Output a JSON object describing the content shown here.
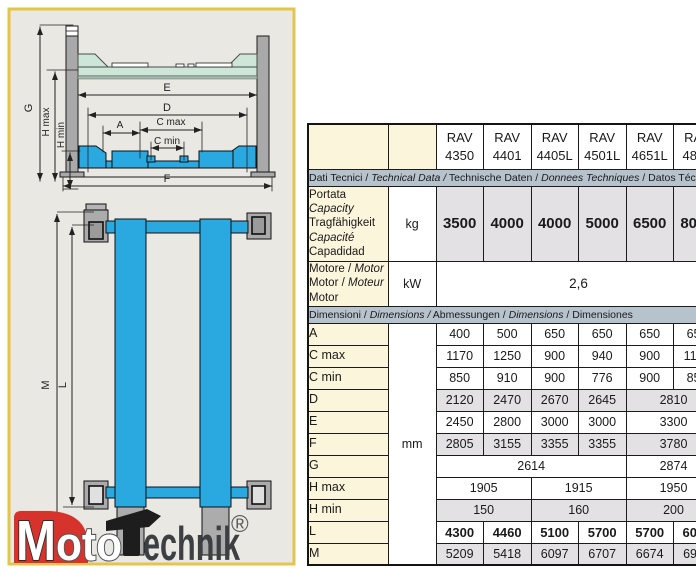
{
  "diagram": {
    "front_labels": {
      "G": "G",
      "h_max": "H max",
      "h_min": "H min",
      "E": "E",
      "D": "D",
      "A": "A",
      "c_max": "C max",
      "c_min": "C min",
      "F": "F"
    },
    "plan_labels": {
      "M": "M",
      "L": "L"
    },
    "colors": {
      "panel_bg": "#EAE8E3",
      "panel_border": "#E4C44C",
      "post_gray": "#A9A9A9",
      "platform_mint": "#CDE6D8",
      "platform_blue": "#2AA9E0"
    }
  },
  "logo": {
    "m": "M",
    "oto": "oto",
    "technik": "echnik",
    "reg": "®",
    "brand_red": "#D6332C"
  },
  "table": {
    "models": [
      {
        "l1": "RAV",
        "l2": "4350"
      },
      {
        "l1": "RAV",
        "l2": "4401"
      },
      {
        "l1": "RAV",
        "l2": "4405L"
      },
      {
        "l1": "RAV",
        "l2": "4501L"
      },
      {
        "l1": "RAV",
        "l2": "4651L"
      },
      {
        "l1": "RAV",
        "l2": "4800"
      }
    ],
    "sections": {
      "tech": [
        {
          "t": "Dati Tecnici / "
        },
        {
          "t": "Technical Data /",
          "i": true
        },
        {
          "t": " Technische Daten / "
        },
        {
          "t": "Donnees Techniques",
          "i": true
        },
        {
          "t": " / Datos Técnicos"
        }
      ],
      "dim": [
        {
          "t": "Dimensioni / "
        },
        {
          "t": "Dimensions /",
          "i": true
        },
        {
          "t": " Abmessungen / "
        },
        {
          "t": "Dimensions",
          "i": true
        },
        {
          "t": " / Dimensiones"
        }
      ]
    },
    "capacity": {
      "label": [
        {
          "t": "Portata"
        },
        {
          "t": "Capacity",
          "i": true
        },
        {
          "t": "Tragfähigkeit"
        },
        {
          "t": "Capacité",
          "i": true
        },
        {
          "t": "Capadidad"
        }
      ],
      "unit": "kg",
      "values": [
        "3500",
        "4000",
        "4000",
        "5000",
        "6500",
        "8000"
      ]
    },
    "motor": {
      "label": [
        [
          {
            "t": "Motore / "
          },
          {
            "t": "Motor",
            "i": true
          }
        ],
        [
          {
            "t": "Motor / "
          },
          {
            "t": "Moteur",
            "i": true
          }
        ],
        [
          {
            "t": "Motor"
          }
        ]
      ],
      "unit": "kW",
      "value": "2,6"
    },
    "dim_unit": "mm",
    "rows": [
      {
        "label": "A",
        "shaded": false,
        "bold": false,
        "cells": [
          {
            "v": "400"
          },
          {
            "v": "500"
          },
          {
            "v": "650"
          },
          {
            "v": "650"
          },
          {
            "v": "650"
          },
          {
            "v": "650"
          }
        ]
      },
      {
        "label": "C max",
        "shaded": false,
        "bold": false,
        "cells": [
          {
            "v": "1170"
          },
          {
            "v": "1250"
          },
          {
            "v": "900"
          },
          {
            "v": "940"
          },
          {
            "v": "900"
          },
          {
            "v": "1150"
          }
        ]
      },
      {
        "label": "C min",
        "shaded": false,
        "bold": false,
        "cells": [
          {
            "v": "850"
          },
          {
            "v": "910"
          },
          {
            "v": "900"
          },
          {
            "v": "776"
          },
          {
            "v": "900"
          },
          {
            "v": "850"
          }
        ]
      },
      {
        "label": "D",
        "shaded": true,
        "bold": false,
        "cells": [
          {
            "v": "2120"
          },
          {
            "v": "2470"
          },
          {
            "v": "2670"
          },
          {
            "v": "2645"
          },
          {
            "v": "2810",
            "span": 2
          }
        ]
      },
      {
        "label": "E",
        "shaded": false,
        "bold": false,
        "cells": [
          {
            "v": "2450"
          },
          {
            "v": "2800"
          },
          {
            "v": "3000"
          },
          {
            "v": "3000"
          },
          {
            "v": "3300",
            "span": 2
          }
        ]
      },
      {
        "label": "F",
        "shaded": true,
        "bold": false,
        "cells": [
          {
            "v": "2805"
          },
          {
            "v": "3155"
          },
          {
            "v": "3355"
          },
          {
            "v": "3355"
          },
          {
            "v": "3780",
            "span": 2
          }
        ]
      },
      {
        "label": "G",
        "shaded": false,
        "bold": false,
        "cells": [
          {
            "v": "2614",
            "span": 4
          },
          {
            "v": "2874",
            "span": 2
          }
        ]
      },
      {
        "label": "H max",
        "shaded": false,
        "bold": false,
        "cells": [
          {
            "v": "1905",
            "span": 2
          },
          {
            "v": "1915",
            "span": 2
          },
          {
            "v": "1950",
            "span": 2
          }
        ]
      },
      {
        "label": "H min",
        "shaded": true,
        "bold": false,
        "cells": [
          {
            "v": "150",
            "span": 2
          },
          {
            "v": "160",
            "span": 2
          },
          {
            "v": "200",
            "span": 2
          }
        ]
      },
      {
        "label": "L",
        "shaded": false,
        "bold": true,
        "cells": [
          {
            "v": "4300"
          },
          {
            "v": "4460"
          },
          {
            "v": "5100"
          },
          {
            "v": "5700"
          },
          {
            "v": "5700"
          },
          {
            "v": "6000"
          }
        ]
      },
      {
        "label": "M",
        "shaded": true,
        "bold": false,
        "cells": [
          {
            "v": "5209"
          },
          {
            "v": "5418"
          },
          {
            "v": "6097"
          },
          {
            "v": "6707"
          },
          {
            "v": "6674"
          },
          {
            "v": "6974"
          }
        ]
      }
    ]
  }
}
